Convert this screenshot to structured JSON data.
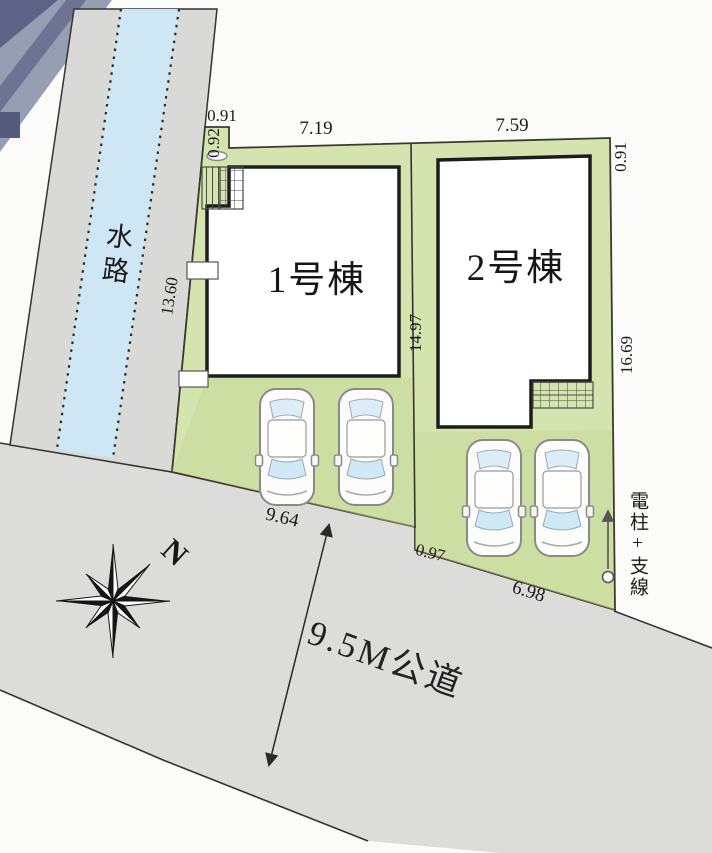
{
  "buildings": [
    {
      "name": "1号棟"
    },
    {
      "name": "2号棟"
    }
  ],
  "labels": {
    "waterway": "水路",
    "road": "9.5M公道",
    "utility_pole": "電柱+支線",
    "compass_north": "N"
  },
  "dimensions": {
    "jog_width": "0.91",
    "jog_height": "0.92",
    "lot1_top": "7.19",
    "lot2_top": "7.59",
    "right_upper": "0.91",
    "left_side": "13.60",
    "divider": "14.97",
    "right_side": "16.69",
    "lot1_frontage": "9.64",
    "frontage_step": "0.97",
    "lot2_frontage": "6.98"
  },
  "colors": {
    "lot_green": "#d5e3ae",
    "road_gray": "#dcdcdb",
    "waterway_gray": "#d9d9d8",
    "water_blue": "#cfe7f5",
    "building_fill": "#ffffff",
    "outline": "#1c1c1c"
  }
}
